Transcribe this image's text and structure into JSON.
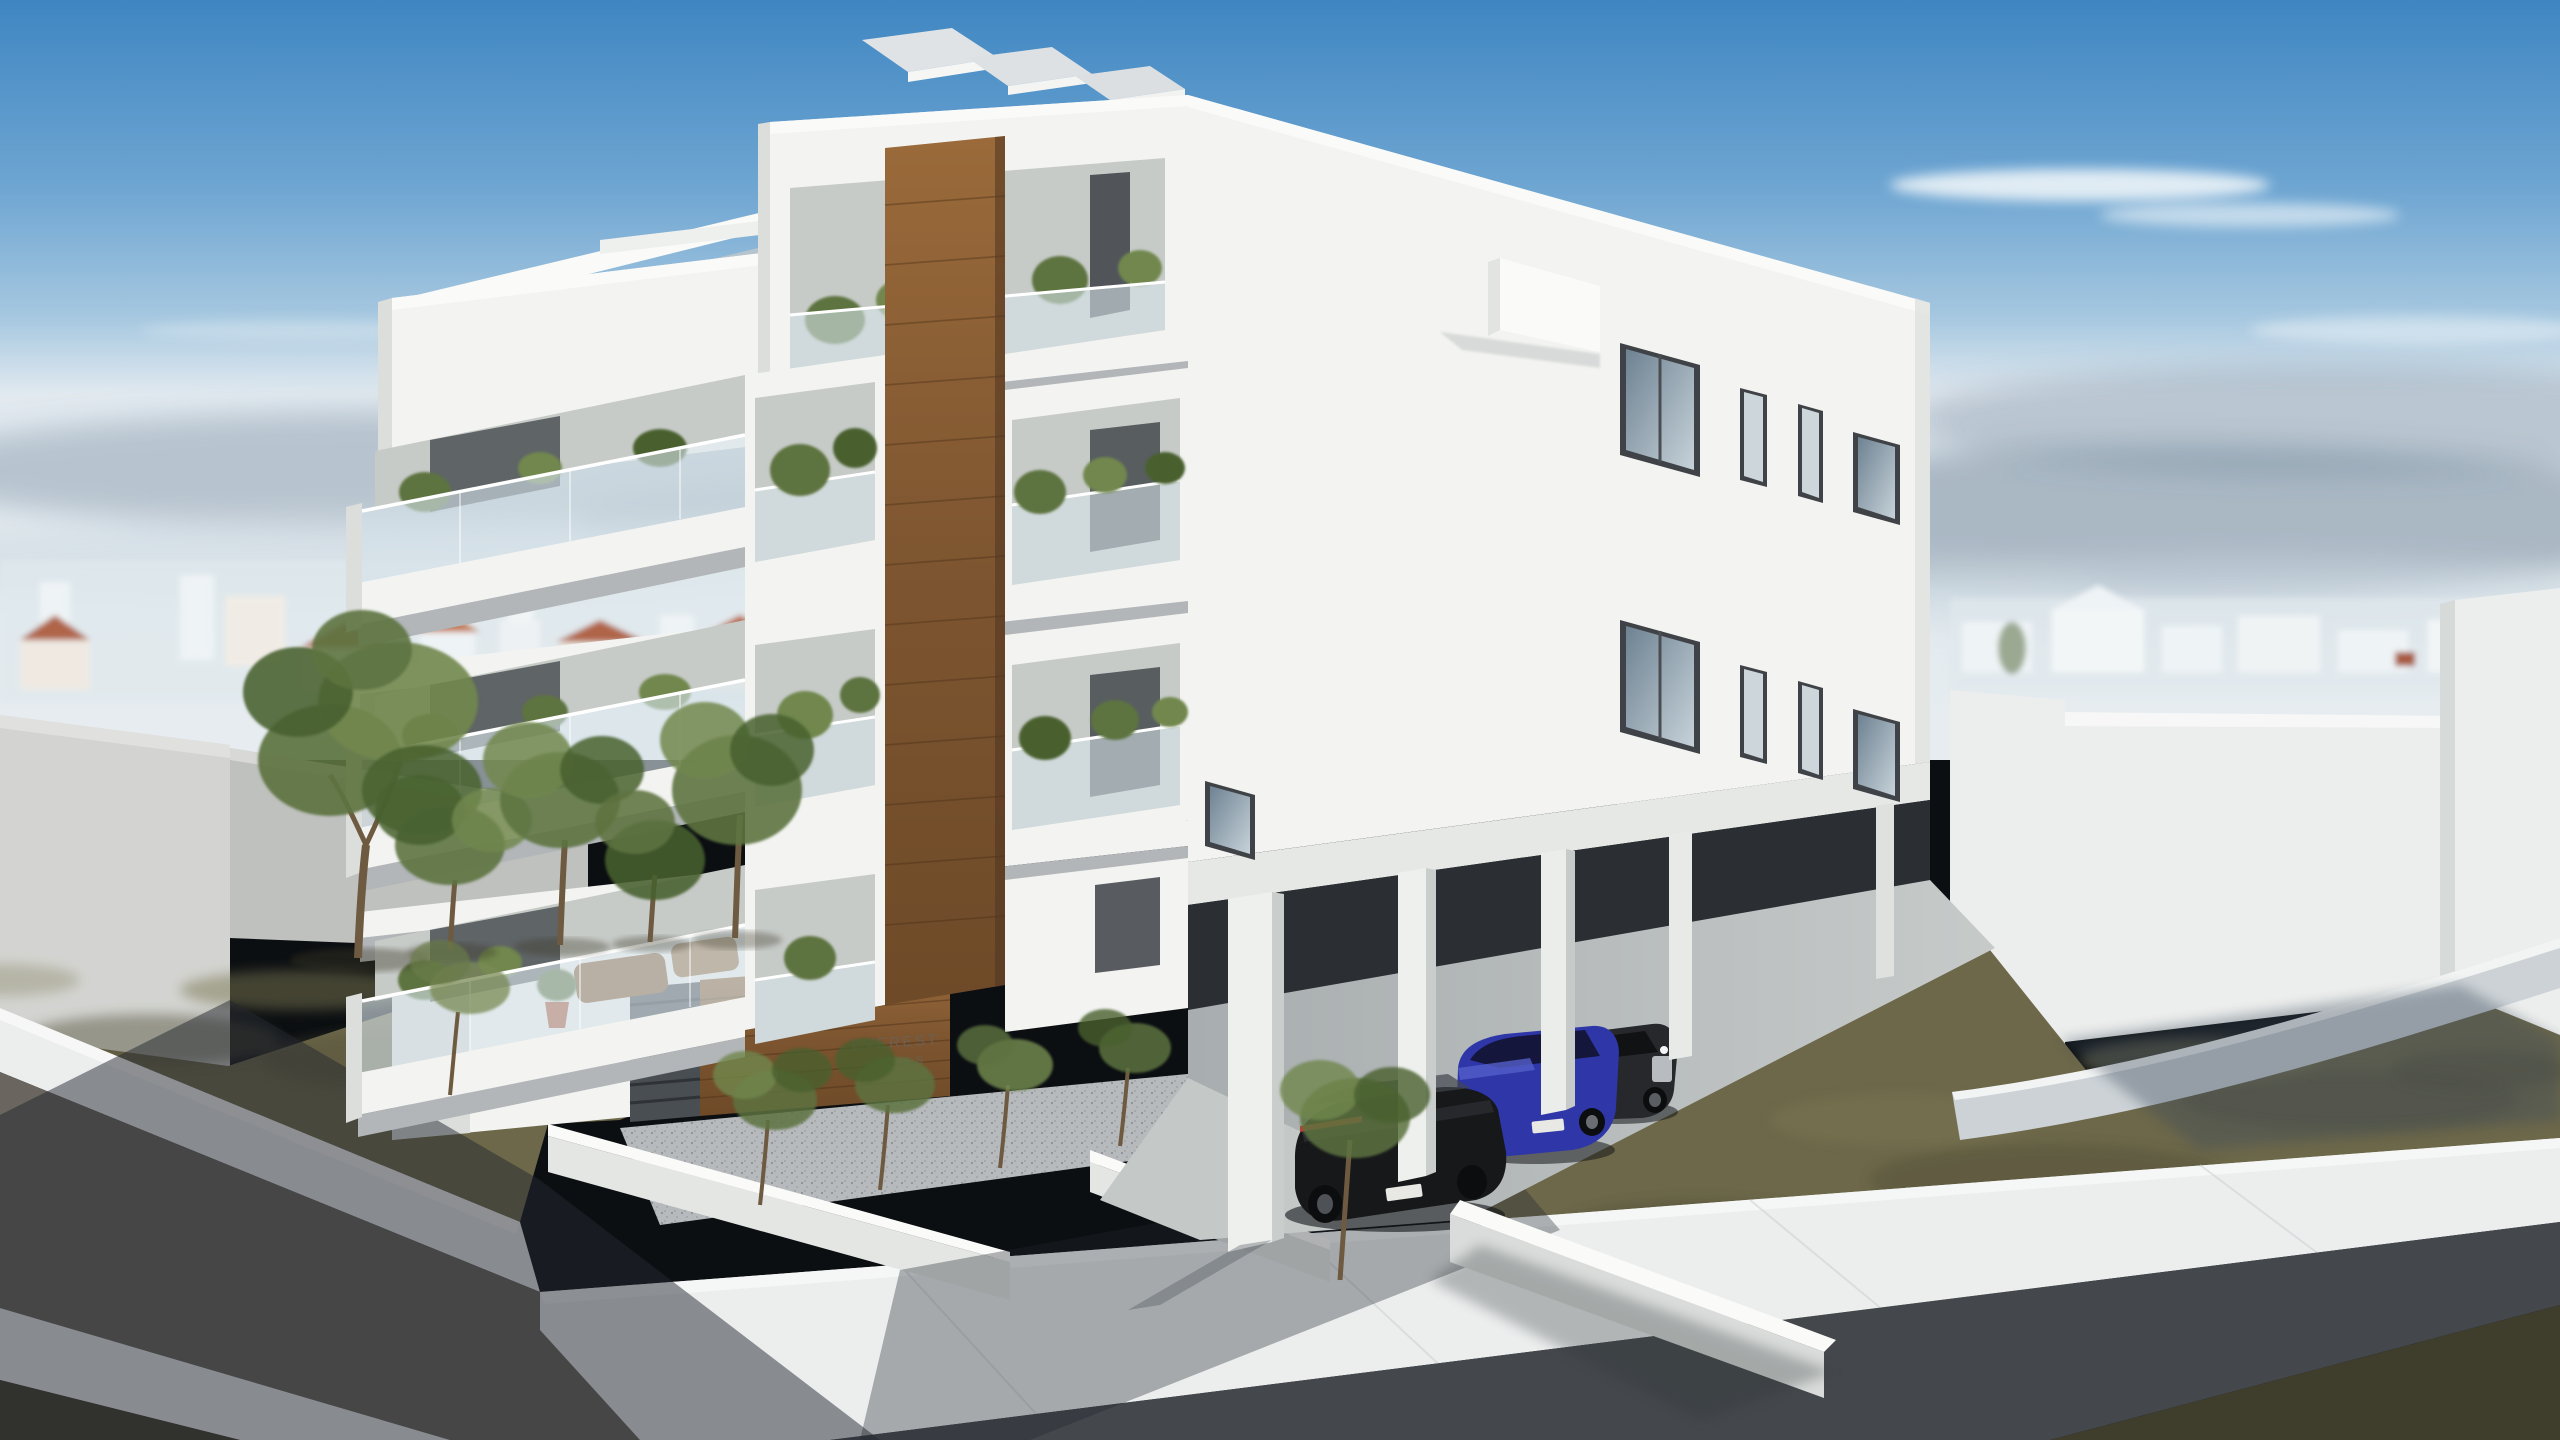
{
  "scene": {
    "title": "Architectural render of a modern white 4-storey apartment building, aerial corner view on a sunny day",
    "sign": {
      "line1": "EVEREST",
      "line2": "HOMES"
    },
    "building": {
      "storeys": "4",
      "features": "roof solar panels, pergola roof terrace, wood accent band, glass balconies with plants, ground-floor parking on pillars"
    },
    "cars": [
      {
        "label": "black SUV"
      },
      {
        "label": "blue hatchback"
      },
      {
        "label": "dark grey car"
      }
    ],
    "environment": "distant hazy city skyline, olive trees on brown grass, asphalt road with light sidewalks, neighbouring white walls"
  },
  "colors": {
    "sky-top": "#3f86c2",
    "sky-mid": "#6fa6d2",
    "sky-low": "#a7c8e0",
    "sky-horizon": "#e2eaf0",
    "cloud-dark": "#708598",
    "cloud-light": "#cdd9e2",
    "cloud-white": "#f4f8fa",
    "skyline-white": "#eef3f5",
    "skyline-roof": "#b06548",
    "skyline-haze": "#dfe8ec",
    "wall-grey-lit": "#d3d4d1",
    "wall-grey-shade": "#bfc1be",
    "grass-left": "#6d684a",
    "grass-dark": "#54503a",
    "grass-light": "#7c7754",
    "grass-corner": "#3f3d2c",
    "tree-green": "#5d7340",
    "tree-green-dark": "#48602f",
    "tree-green-light": "#71874e",
    "trunk": "#7d6647",
    "neighbor-lit": "#eceeed",
    "neighbor-shade": "#d6dad9",
    "neighbor-sidewalk": "#ccd2d6",
    "road-lit": "#6a655e",
    "sidewalk-lit": "#eceeee",
    "curb": "#f6f7f6",
    "building-lit": "#f3f4f1",
    "building-bright": "#fafaf8",
    "building-shade": "#dcdedb",
    "slab-shadow": "#b2b6b9",
    "recess": "#c7cbc8",
    "deep-shadow": "#8d9295",
    "wood-light": "#9a6a3a",
    "wood-dark": "#6e4a28",
    "wood-edge": "#503520",
    "glass-rail": "#d5e2e8",
    "window-frame": "#3f4347",
    "glass-dark": "#6e8292",
    "glass-light": "#c6d2d9",
    "parking-void": "#2b2f33",
    "parking-floor": "#a8adaf",
    "parking-floor-lit": "#c6cac9",
    "apron": "#c4c8c7",
    "car-black": "#17181a",
    "car-black-hi": "#41464d",
    "car-blue": "#2e36a8",
    "car-blue-hi": "#545fc8",
    "car-grey": "#26282c",
    "wheel": "#0c0d0f",
    "tail-light": "#c23a31",
    "plate": "#e8e9e4",
    "grille": "#c9ccd0",
    "gravel": "#b7babd",
    "gravel-dot": "#8e9296",
    "shadow-overlay": "#232830",
    "sign-text": "#6b6257",
    "pot": "#b05a3a",
    "wicker": "#8a5f35"
  }
}
